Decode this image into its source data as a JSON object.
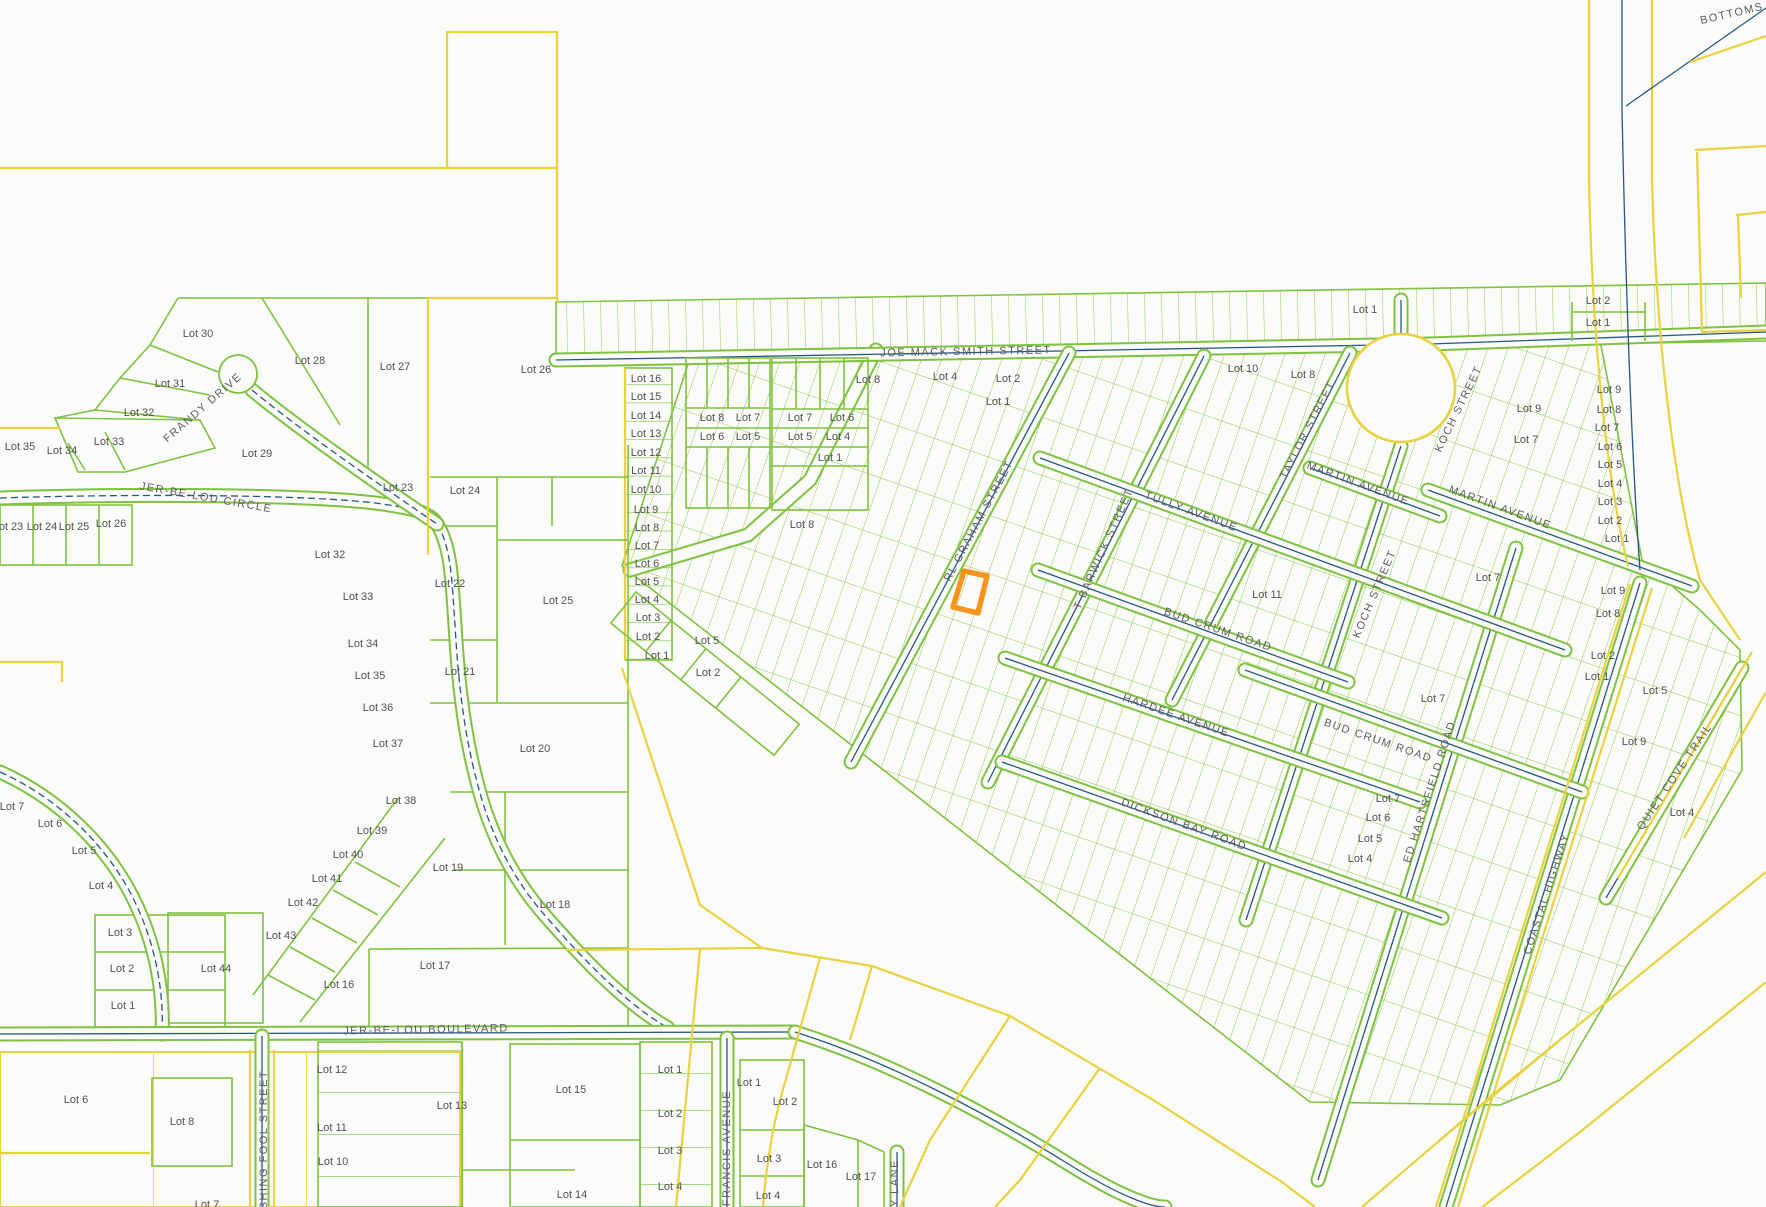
{
  "map": {
    "type": "cadastral-parcel-map",
    "colors": {
      "background": "#FBFBF9",
      "parcel_line_green": "#7FC241",
      "boundary_yellow": "#E8D23E",
      "road_blue": "#265784",
      "highlight_orange": "#F7941D",
      "label_gray": "#515155"
    },
    "highlight": {
      "name": "selected-parcel",
      "color": "#F7941D",
      "points": "964,571 987,576 978,613 953,607"
    },
    "street_labels": [
      {
        "t": "JOE MACK SMITH STREET",
        "x": 966,
        "y": 352,
        "r": -1
      },
      {
        "t": "FRANDY DRIVE",
        "x": 203,
        "y": 408,
        "r": -41
      },
      {
        "t": "JER-BE-LOU CIRCLE",
        "x": 206,
        "y": 498,
        "r": 10
      },
      {
        "t": "JER-BE-LOU BOULEVARD",
        "x": 426,
        "y": 1030,
        "r": -1
      },
      {
        "t": "FISHING FOOL STREET",
        "x": 264,
        "y": 1146,
        "r": -90
      },
      {
        "t": "FRANCIS AVENUE",
        "x": 727,
        "y": 1148,
        "r": -90
      },
      {
        "t": "LACY LANE",
        "x": 895,
        "y": 1196,
        "r": -90
      },
      {
        "t": "RL GRAHAM STREET",
        "x": 979,
        "y": 521,
        "r": -62
      },
      {
        "t": "T BARWICK STREET",
        "x": 1104,
        "y": 549,
        "r": -66
      },
      {
        "t": "TULLY AVENUE",
        "x": 1191,
        "y": 512,
        "r": 20
      },
      {
        "t": "TAYLOR STREET",
        "x": 1308,
        "y": 430,
        "r": -63
      },
      {
        "t": "MARTIN AVENUE",
        "x": 1358,
        "y": 484,
        "r": 20
      },
      {
        "t": "MARTIN AVENUE",
        "x": 1500,
        "y": 508,
        "r": 20
      },
      {
        "t": "KOCH STREET",
        "x": 1459,
        "y": 409,
        "r": -64
      },
      {
        "t": "KOCH STREET",
        "x": 1375,
        "y": 594,
        "r": -67
      },
      {
        "t": "BUD CRUM ROAD",
        "x": 1218,
        "y": 630,
        "r": 19
      },
      {
        "t": "BUD CRUM ROAD",
        "x": 1378,
        "y": 741,
        "r": 19
      },
      {
        "t": "HARDEE AVENUE",
        "x": 1176,
        "y": 716,
        "r": 19
      },
      {
        "t": "DICKSON BAY ROAD",
        "x": 1184,
        "y": 825,
        "r": 20
      },
      {
        "t": "ED HARTSFIELD ROAD",
        "x": 1430,
        "y": 792,
        "r": -72
      },
      {
        "t": "COASTAL HIGHWAY",
        "x": 1547,
        "y": 894,
        "r": -72
      },
      {
        "t": "QUIET COVE TRAIL",
        "x": 1675,
        "y": 777,
        "r": -56
      },
      {
        "t": "BOTTOMS",
        "x": 1732,
        "y": 14,
        "r": -13
      }
    ],
    "lot_labels": [
      {
        "t": "Lot 30",
        "x": 198,
        "y": 334
      },
      {
        "t": "Lot 31",
        "x": 170,
        "y": 384
      },
      {
        "t": "Lot 32",
        "x": 139,
        "y": 413
      },
      {
        "t": "Lot 33",
        "x": 109,
        "y": 442
      },
      {
        "t": "Lot 34",
        "x": 62,
        "y": 451
      },
      {
        "t": "Lot 35",
        "x": 20,
        "y": 447
      },
      {
        "t": "Lot 28",
        "x": 310,
        "y": 361
      },
      {
        "t": "Lot 27",
        "x": 395,
        "y": 367
      },
      {
        "t": "Lot 29",
        "x": 257,
        "y": 454
      },
      {
        "t": "Lot 23",
        "x": 398,
        "y": 488
      },
      {
        "t": "Lot 24",
        "x": 465,
        "y": 491
      },
      {
        "t": "Lot 26",
        "x": 536,
        "y": 370
      },
      {
        "t": "Lot 23",
        "x": 8,
        "y": 527
      },
      {
        "t": "Lot 24",
        "x": 42,
        "y": 527
      },
      {
        "t": "Lot 25",
        "x": 74,
        "y": 527
      },
      {
        "t": "Lot 26",
        "x": 111,
        "y": 524
      },
      {
        "t": "Lot 32",
        "x": 330,
        "y": 555
      },
      {
        "t": "Lot 33",
        "x": 358,
        "y": 597
      },
      {
        "t": "Lot 34",
        "x": 363,
        "y": 644
      },
      {
        "t": "Lot 35",
        "x": 370,
        "y": 676
      },
      {
        "t": "Lot 36",
        "x": 378,
        "y": 708
      },
      {
        "t": "Lot 37",
        "x": 388,
        "y": 744
      },
      {
        "t": "Lot 38",
        "x": 401,
        "y": 801
      },
      {
        "t": "Lot 39",
        "x": 372,
        "y": 831
      },
      {
        "t": "Lot 40",
        "x": 348,
        "y": 855
      },
      {
        "t": "Lot 41",
        "x": 327,
        "y": 879
      },
      {
        "t": "Lot 42",
        "x": 303,
        "y": 903
      },
      {
        "t": "Lot 43",
        "x": 281,
        "y": 936
      },
      {
        "t": "Lot 44",
        "x": 216,
        "y": 969
      },
      {
        "t": "Lot 22",
        "x": 450,
        "y": 584
      },
      {
        "t": "Lot 25",
        "x": 558,
        "y": 601
      },
      {
        "t": "Lot 21",
        "x": 460,
        "y": 672
      },
      {
        "t": "Lot 20",
        "x": 535,
        "y": 749
      },
      {
        "t": "Lot 19",
        "x": 448,
        "y": 868
      },
      {
        "t": "Lot 18",
        "x": 555,
        "y": 905
      },
      {
        "t": "Lot 7",
        "x": 12,
        "y": 807
      },
      {
        "t": "Lot 6",
        "x": 50,
        "y": 824
      },
      {
        "t": "Lot 5",
        "x": 84,
        "y": 851
      },
      {
        "t": "Lot 4",
        "x": 101,
        "y": 886
      },
      {
        "t": "Lot 3",
        "x": 120,
        "y": 933
      },
      {
        "t": "Lot 2",
        "x": 122,
        "y": 969
      },
      {
        "t": "Lot 1",
        "x": 123,
        "y": 1006
      },
      {
        "t": "Lot 6",
        "x": 76,
        "y": 1100
      },
      {
        "t": "Lot 8",
        "x": 182,
        "y": 1122
      },
      {
        "t": "Lot 7",
        "x": 207,
        "y": 1205
      },
      {
        "t": "Lot 12",
        "x": 332,
        "y": 1070
      },
      {
        "t": "Lot 11",
        "x": 332,
        "y": 1128
      },
      {
        "t": "Lot 10",
        "x": 333,
        "y": 1162
      },
      {
        "t": "Lot 13",
        "x": 452,
        "y": 1106
      },
      {
        "t": "Lot 16",
        "x": 339,
        "y": 985
      },
      {
        "t": "Lot 17",
        "x": 435,
        "y": 966
      },
      {
        "t": "Lot 15",
        "x": 571,
        "y": 1090
      },
      {
        "t": "Lot 14",
        "x": 572,
        "y": 1195
      },
      {
        "t": "Lot 1",
        "x": 670,
        "y": 1070
      },
      {
        "t": "Lot 2",
        "x": 670,
        "y": 1114
      },
      {
        "t": "Lot 3",
        "x": 670,
        "y": 1151
      },
      {
        "t": "Lot 4",
        "x": 670,
        "y": 1187
      },
      {
        "t": "Lot 1",
        "x": 749,
        "y": 1083
      },
      {
        "t": "Lot 2",
        "x": 785,
        "y": 1102
      },
      {
        "t": "Lot 3",
        "x": 769,
        "y": 1159
      },
      {
        "t": "Lot 4",
        "x": 768,
        "y": 1196
      },
      {
        "t": "Lot 16",
        "x": 822,
        "y": 1165
      },
      {
        "t": "Lot 17",
        "x": 861,
        "y": 1177
      },
      {
        "t": "Lot 16",
        "x": 646,
        "y": 379
      },
      {
        "t": "Lot 15",
        "x": 646,
        "y": 397
      },
      {
        "t": "Lot 14",
        "x": 646,
        "y": 416
      },
      {
        "t": "Lot 13",
        "x": 646,
        "y": 434
      },
      {
        "t": "Lot 12",
        "x": 646,
        "y": 453
      },
      {
        "t": "Lot 11",
        "x": 646,
        "y": 471
      },
      {
        "t": "Lot 10",
        "x": 646,
        "y": 490
      },
      {
        "t": "Lot 9",
        "x": 646,
        "y": 510
      },
      {
        "t": "Lot 8",
        "x": 647,
        "y": 528
      },
      {
        "t": "Lot 7",
        "x": 647,
        "y": 546
      },
      {
        "t": "Lot 6",
        "x": 647,
        "y": 564
      },
      {
        "t": "Lot 5",
        "x": 647,
        "y": 582
      },
      {
        "t": "Lot 4",
        "x": 647,
        "y": 600
      },
      {
        "t": "Lot 3",
        "x": 648,
        "y": 618
      },
      {
        "t": "Lot 2",
        "x": 648,
        "y": 637
      },
      {
        "t": "Lot 1",
        "x": 657,
        "y": 656
      },
      {
        "t": "Lot 5",
        "x": 707,
        "y": 641
      },
      {
        "t": "Lot 2",
        "x": 708,
        "y": 673
      },
      {
        "t": "Lot 8",
        "x": 802,
        "y": 525
      },
      {
        "t": "Lot 8",
        "x": 712,
        "y": 418
      },
      {
        "t": "Lot 7",
        "x": 748,
        "y": 418
      },
      {
        "t": "Lot 6",
        "x": 712,
        "y": 437
      },
      {
        "t": "Lot 5",
        "x": 748,
        "y": 437
      },
      {
        "t": "Lot 7",
        "x": 800,
        "y": 418
      },
      {
        "t": "Lot 6",
        "x": 842,
        "y": 418
      },
      {
        "t": "Lot 5",
        "x": 800,
        "y": 437
      },
      {
        "t": "Lot 4",
        "x": 838,
        "y": 437
      },
      {
        "t": "Lot 1",
        "x": 830,
        "y": 458
      },
      {
        "t": "Lot 8",
        "x": 868,
        "y": 380
      },
      {
        "t": "Lot 4",
        "x": 945,
        "y": 377
      },
      {
        "t": "Lot 2",
        "x": 1008,
        "y": 379
      },
      {
        "t": "Lot 1",
        "x": 998,
        "y": 402
      },
      {
        "t": "Lot 10",
        "x": 1243,
        "y": 369
      },
      {
        "t": "Lot 8",
        "x": 1303,
        "y": 375
      },
      {
        "t": "Lot 1",
        "x": 1365,
        "y": 310
      },
      {
        "t": "Lot 2",
        "x": 1598,
        "y": 301
      },
      {
        "t": "Lot 1",
        "x": 1598,
        "y": 323
      },
      {
        "t": "Lot 9",
        "x": 1529,
        "y": 409
      },
      {
        "t": "Lot 7",
        "x": 1526,
        "y": 440
      },
      {
        "t": "Lot 7",
        "x": 1488,
        "y": 578
      },
      {
        "t": "Lot 11",
        "x": 1267,
        "y": 595
      },
      {
        "t": "Lot 7",
        "x": 1433,
        "y": 699
      },
      {
        "t": "Lot 7",
        "x": 1388,
        "y": 799
      },
      {
        "t": "Lot 6",
        "x": 1378,
        "y": 818
      },
      {
        "t": "Lot 5",
        "x": 1370,
        "y": 839
      },
      {
        "t": "Lot 4",
        "x": 1360,
        "y": 859
      },
      {
        "t": "Lot 9",
        "x": 1609,
        "y": 390
      },
      {
        "t": "Lot 8",
        "x": 1609,
        "y": 410
      },
      {
        "t": "Lot 7",
        "x": 1607,
        "y": 428
      },
      {
        "t": "Lot 6",
        "x": 1610,
        "y": 447
      },
      {
        "t": "Lot 5",
        "x": 1610,
        "y": 465
      },
      {
        "t": "Lot 4",
        "x": 1610,
        "y": 484
      },
      {
        "t": "Lot 3",
        "x": 1610,
        "y": 502
      },
      {
        "t": "Lot 2",
        "x": 1610,
        "y": 521
      },
      {
        "t": "Lot 1",
        "x": 1617,
        "y": 539
      },
      {
        "t": "Lot 9",
        "x": 1613,
        "y": 591
      },
      {
        "t": "Lot 8",
        "x": 1608,
        "y": 614
      },
      {
        "t": "Lot 2",
        "x": 1603,
        "y": 656
      },
      {
        "t": "Lot 1",
        "x": 1597,
        "y": 677
      },
      {
        "t": "Lot 5",
        "x": 1655,
        "y": 691
      },
      {
        "t": "Lot 9",
        "x": 1634,
        "y": 742
      },
      {
        "t": "Lot 4",
        "x": 1682,
        "y": 813
      }
    ]
  }
}
